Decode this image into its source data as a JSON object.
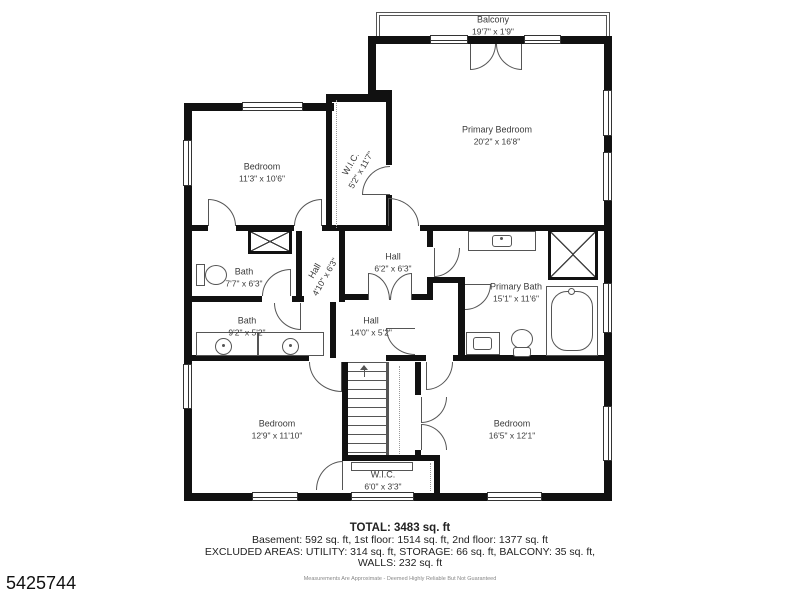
{
  "plan": {
    "balcony": {
      "label": "Balcony",
      "dims": "19'7\" x 1'9\""
    },
    "rooms": {
      "primary_bedroom": {
        "label": "Primary Bedroom",
        "dims": "20'2\" x 16'8\""
      },
      "bedroom_top_left": {
        "label": "Bedroom",
        "dims": "11'3\" x 10'6\""
      },
      "wic_top": {
        "label": "W.I.C.",
        "dims": "5'2\" x 11'7\""
      },
      "bath_top": {
        "label": "Bath",
        "dims": "7'7\" x 6'3\""
      },
      "hall_small": {
        "label": "Hall",
        "dims": "4'10\" x 6'3\""
      },
      "hall_mid": {
        "label": "Hall",
        "dims": "6'2\" x 6'3\""
      },
      "primary_bath": {
        "label": "Primary Bath",
        "dims": "15'1\" x 11'6\""
      },
      "bath_lower": {
        "label": "Bath",
        "dims": "9'2\" x 5'2\""
      },
      "hall_main": {
        "label": "Hall",
        "dims": "14'0\" x 5'2\""
      },
      "bedroom_bottom_left": {
        "label": "Bedroom",
        "dims": "12'9\" x 11'10\""
      },
      "bedroom_bottom_right": {
        "label": "Bedroom",
        "dims": "16'5\" x 12'1\""
      },
      "wic_bottom": {
        "label": "W.I.C.",
        "dims": "6'0\" x 3'3\""
      }
    }
  },
  "summary": {
    "total": "TOTAL: 3483 sq. ft",
    "floors": "Basement: 592 sq. ft, 1st floor: 1514 sq. ft, 2nd floor: 1377 sq. ft",
    "excluded": "EXCLUDED AREAS: UTILITY: 314 sq. ft, STORAGE: 66 sq. ft, BALCONY: 35 sq. ft,",
    "walls": "WALLS: 232 sq. ft",
    "disclaimer": "Measurements Are Approximate - Deemed Highly Reliable But Not Guaranteed"
  },
  "listing_id": "5425744",
  "colors": {
    "wall": "#111111",
    "line": "#555555"
  }
}
